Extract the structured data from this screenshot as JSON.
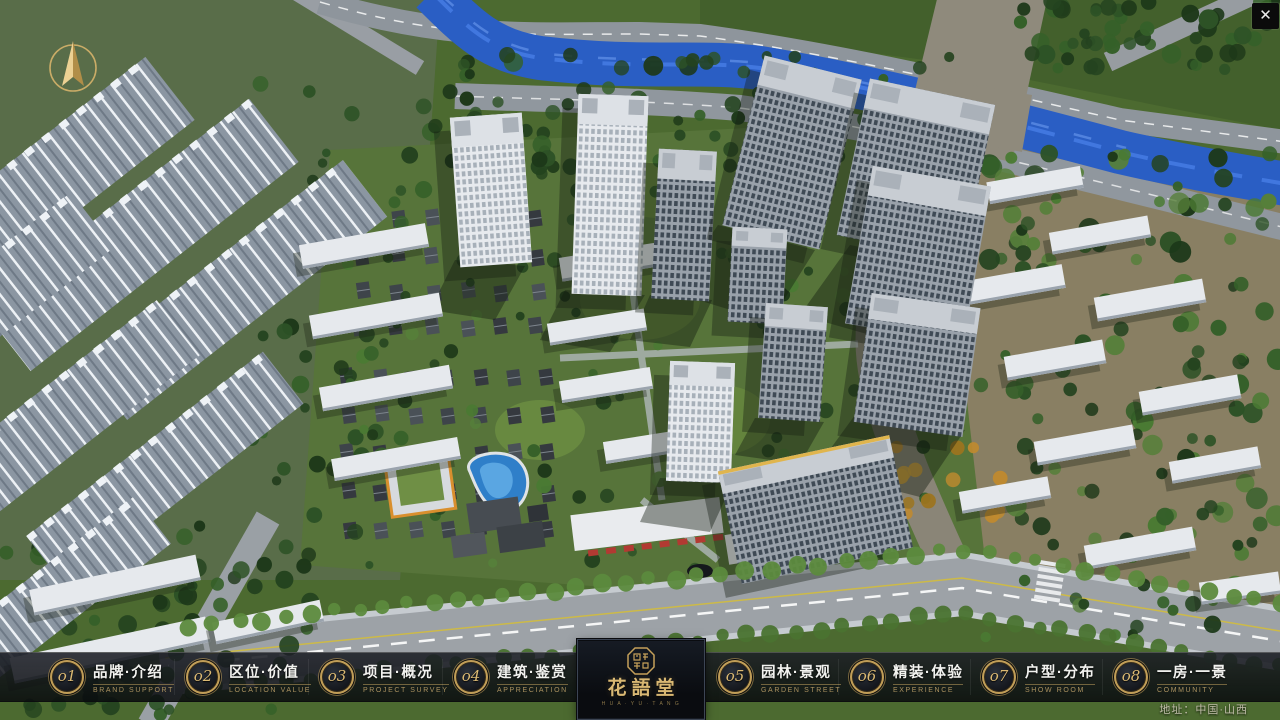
{
  "brand": {
    "name_zh": "花語堂",
    "tagline_en": "H U A · Y U · T A N G"
  },
  "nav": {
    "items": [
      {
        "num": "o1",
        "zh": "品牌·介绍",
        "en": "BRAND SUPPORT"
      },
      {
        "num": "o2",
        "zh": "区位·价值",
        "en": "LOCATION VALUE"
      },
      {
        "num": "o3",
        "zh": "项目·概况",
        "en": "PROJECT SURVEY"
      },
      {
        "num": "o4",
        "zh": "建筑·鉴赏",
        "en": "APPRECIATION"
      },
      {
        "num": "o5",
        "zh": "园林·景观",
        "en": "GARDEN STREET"
      },
      {
        "num": "o6",
        "zh": "精装·体验",
        "en": "EXPERIENCE"
      },
      {
        "num": "o7",
        "zh": "户型·分布",
        "en": "SHOW ROOM"
      },
      {
        "num": "o8",
        "zh": "一房·一景",
        "en": "COMMUNITY"
      }
    ]
  },
  "footer": {
    "address": "地址：中国·山西"
  },
  "window": {
    "close_icon": "✕"
  },
  "colors": {
    "gold": "#C9A45C",
    "bar_bg": "rgba(10,12,16,0.86)",
    "river": "#2A5EC4"
  }
}
